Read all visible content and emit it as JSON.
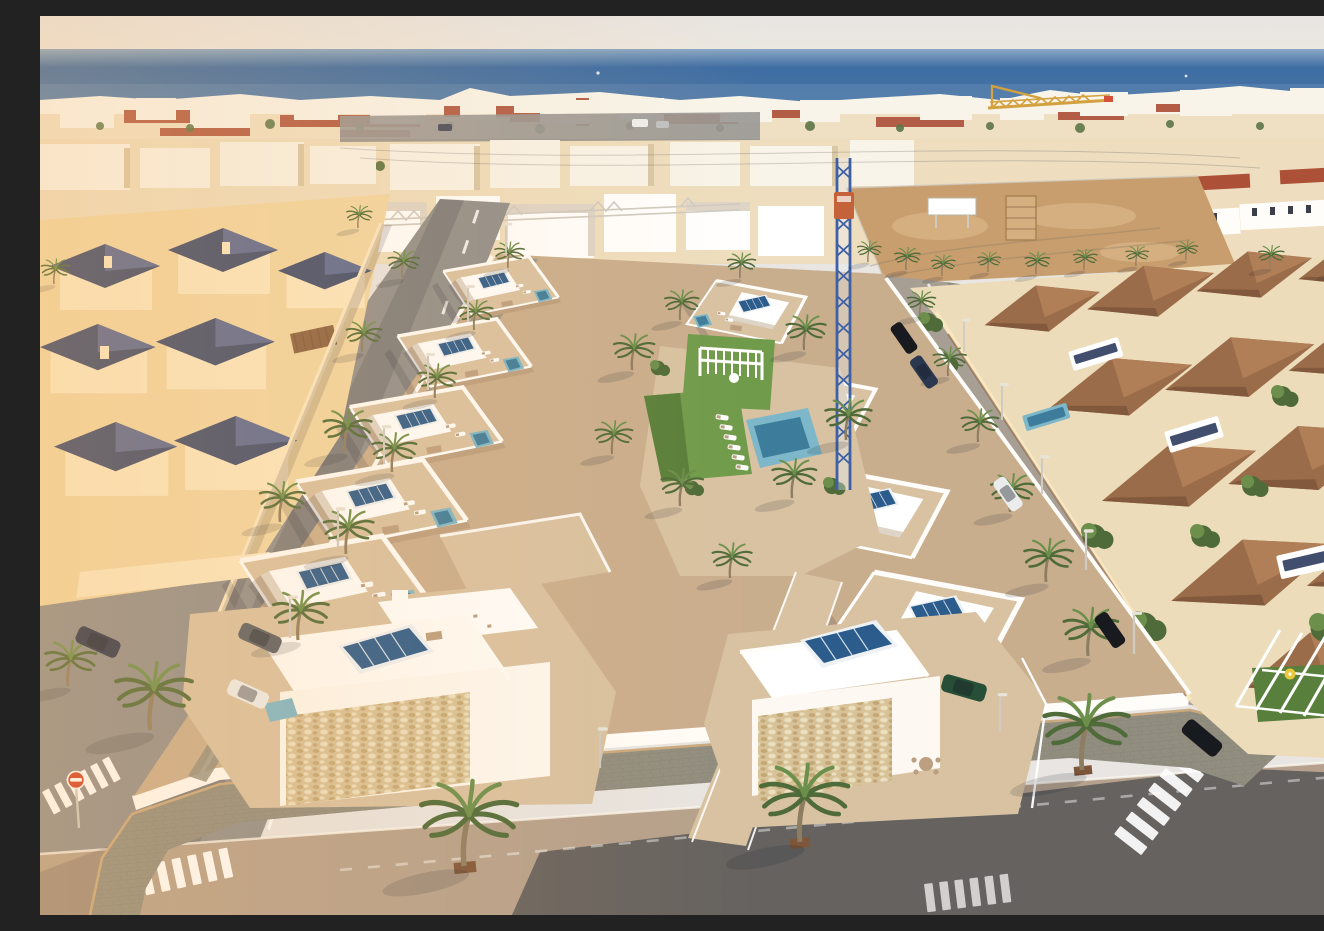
{
  "meta": {
    "description": "Sunset aerial drone view of a new-build complex of white flat-roofed villas with roof terraces, solar panels, plunge pools and a communal lawn with swimming pool, set in a dense coastal town with older peach villas with dark tile roofs on the left, terracotta-roofed townhouses on the right, palm-lined streets with parked cars, a tower crane over a vacant sandy lot, and the blue Mediterranean Sea on the horizon under a pale evening sky."
  },
  "palette": {
    "sky": "#e8e5e2",
    "skylow": "#ece8e1",
    "seahaze": "#8aa8c4",
    "sea": "#3e6da4",
    "sealow": "#4a76a4",
    "towncream": "#ecdcba",
    "townwhite": "#f8f4e9",
    "townshade": "#d9c8a6",
    "roofred": "#ad5038",
    "peach": "#f1d7a4",
    "peachlit": "#fae8c2",
    "peachshade": "#ddb987",
    "slate": "#414e6e",
    "slatelit": "#5d6a93",
    "asphalt": "#908f8d",
    "asphaltlit": "#a89f94",
    "roadwarm": "#b5a18d",
    "roaddark": "#5c5b5b",
    "paver": "#918e80",
    "devtan": "#c9ae8e",
    "devtan2": "#d8c2a2",
    "devtan3": "#bb9f80",
    "white": "#ffffff",
    "warmwhite": "#fdf9f2",
    "brightwhite": "#fffdf9",
    "shadewhite": "#ded5c8",
    "stone": "#d8c298",
    "stone2": "#c3a877",
    "stone3": "#eadfbf",
    "solar": "#2c5c8c",
    "solarframe": "#eef2f5",
    "aqua": "#7db7c9",
    "aquadeep": "#3d7d9b",
    "lawn": "#6f9b4b",
    "lawn2": "#587f3b",
    "palm": "#4f6b39",
    "palm2": "#6c8f4c",
    "trunk": "#8e7d61",
    "terra": "#9b6c49",
    "terra2": "#b07f58",
    "terra3": "#7e563a",
    "dirt": "#c89e6f",
    "dirt2": "#d6af80",
    "craney": "#d0992f",
    "craneb": "#3e61a6",
    "cranec": "#c4633a",
    "carnavy": "#2c3850",
    "carblack": "#191a1e",
    "carwhite": "#ebedec",
    "cargreen": "#274f38",
    "cargray": "#5a5f66",
    "signred": "#d2432a",
    "parasol": "#e8c93e",
    "shadow": "rgba(28,32,48,0.30)",
    "shadow2": "rgba(28,32,48,0.16)",
    "glowc": "#ffb866"
  },
  "scene": {
    "regions": [
      {
        "name": "sky",
        "label": "pale evening sky"
      },
      {
        "name": "sea",
        "label": "Mediterranean Sea horizon"
      },
      {
        "name": "horizon-town",
        "label": "dense coastal town, white and cream buildings with red tile roofs"
      },
      {
        "name": "vacant-lot",
        "label": "sandy construction lot with white billboard"
      },
      {
        "name": "crane",
        "label": "blue tower-crane mast and distant yellow jib"
      },
      {
        "name": "old-town-villas",
        "label": "peach villas with dark pyramid roofs in low sun"
      },
      {
        "name": "new-development",
        "label": "two rows of white villas with roof terraces, solar panels and pools"
      },
      {
        "name": "communal-garden",
        "label": "central lawn, pergola, sun loungers and turquoise pool"
      },
      {
        "name": "terracotta-houses",
        "label": "terracotta-roofed townhouses with conservatories and gardens"
      },
      {
        "name": "streets",
        "label": "palm-lined streets with crosswalks, lamps and parked cars"
      }
    ],
    "objects": {
      "cars": [
        "navy parked",
        "gray parked",
        "white parked",
        "white driving",
        "black parked",
        "black at corner",
        "dark-green at villa"
      ],
      "signs": [
        "no-entry disc"
      ],
      "crosswalks": 4,
      "solar_panels": "on every villa roof",
      "palm_trees": "lining streets, garden and sidewalks"
    }
  }
}
